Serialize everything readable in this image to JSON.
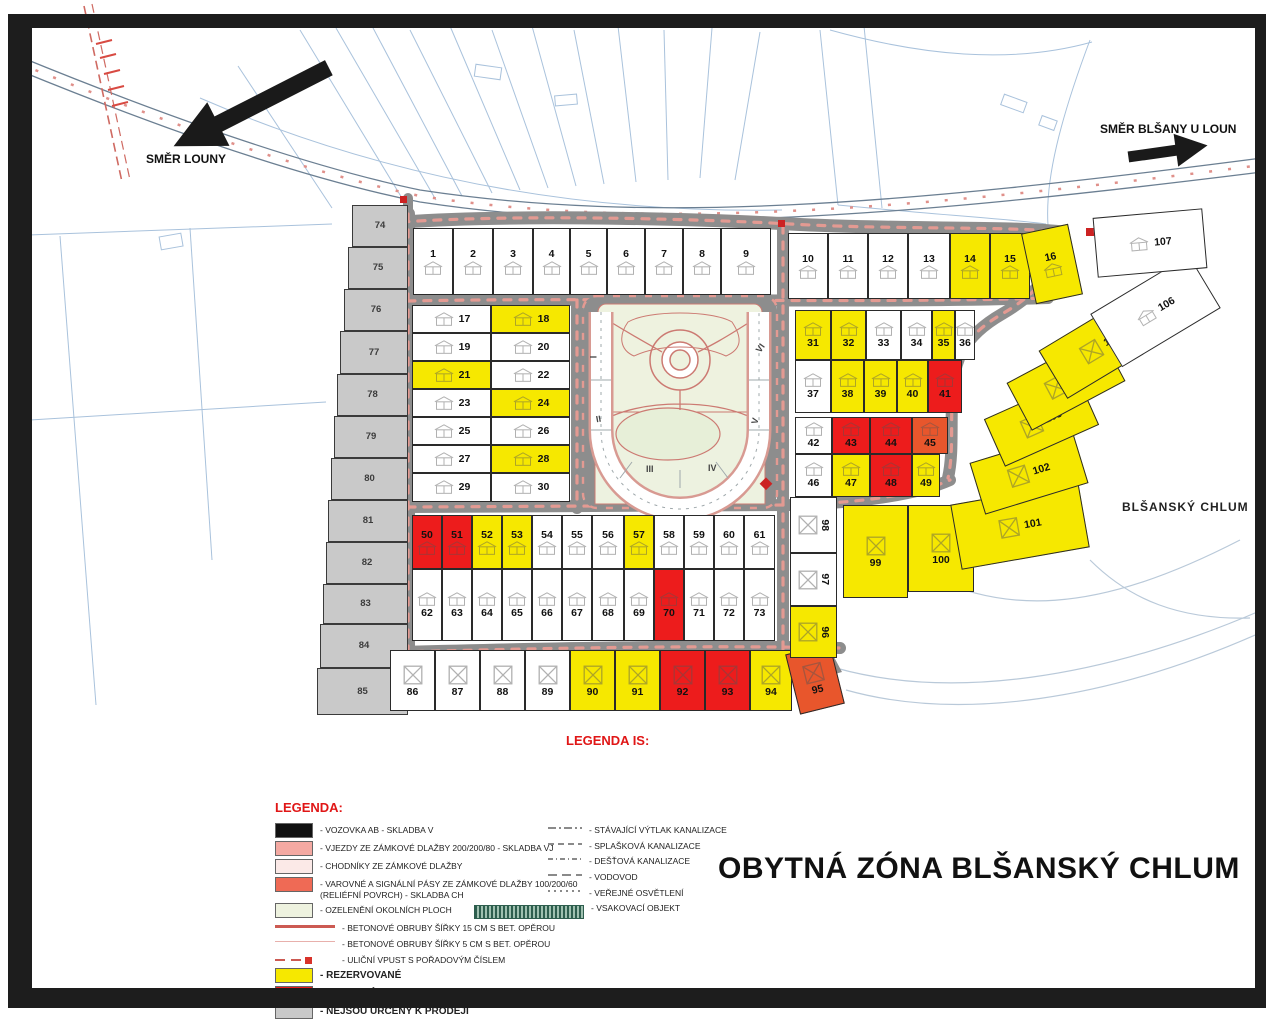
{
  "title": "OBYTNÁ ZÓNA BLŠANSKÝ CHLUM",
  "area_label": "BLŠANSKÝ CHLUM",
  "directions": {
    "west": "SMĚR LOUNY",
    "east": "SMĚR BLŠANY U LOUN"
  },
  "status_colors": {
    "reserved": "#f6e800",
    "sold": "#ed1c1c",
    "sold_alt": "#e8562c",
    "not_for_sale": "#c9c9c9",
    "available": "#ffffff"
  },
  "legend": {
    "title": "LEGENDA:",
    "items": [
      {
        "swatch": "#111111",
        "label": "- VOZOVKA AB - SKLADBA V"
      },
      {
        "swatch": "#f4a9a2",
        "label": "- VJEZDY ZE ZÁMKOVÉ DLAŽBY 200/200/80 - SKLADBA VJ"
      },
      {
        "swatch": "#fbe9e7",
        "label": "- CHODNÍKY ZE ZÁMKOVÉ DLAŽBY"
      },
      {
        "swatch": "#ef6a55",
        "label": "- VAROVNÉ A SIGNÁLNÍ PÁSY ZE ZÁMKOVÉ DLAŽBY 100/200/60 (RELIÉFNÍ POVRCH) - SKLADBA CH"
      },
      {
        "swatch": "#eef2df",
        "label": "- OZELENĚNÍ OKOLNÍCH PLOCH"
      },
      {
        "glyph": "thick",
        "label": "- BETONOVÉ OBRUBY ŠÍŘKY 15 CM S BET. OPĚROU"
      },
      {
        "glyph": "thin",
        "label": "- BETONOVÉ OBRUBY ŠÍŘKY 5 CM S BET. OPĚROU"
      },
      {
        "glyph": "inlet",
        "label": "- ULIČNÍ VPUST S POŘADOVÝM ČÍSLEM"
      },
      {
        "swatch": "#f6e800",
        "label": "- REZERVOVANÉ",
        "bold": true
      },
      {
        "swatch": "#ed1c1c",
        "label": "- PRODANÉ",
        "bold": true
      },
      {
        "swatch": "#c9c9c9",
        "label": "- NEJSOU URČENY K PRODEJI",
        "bold": true
      }
    ]
  },
  "legend_is": {
    "title": "LEGENDA IS:",
    "items": [
      {
        "glyph": "dashdot",
        "label": "- STÁVAJÍCÍ VÝTLAK KANALIZACE"
      },
      {
        "glyph": "dash",
        "label": "- SPLAŠKOVÁ KANALIZACE"
      },
      {
        "glyph": "dashdot2",
        "label": "- DEŠŤOVÁ KANALIZACE"
      },
      {
        "glyph": "dash2",
        "label": "- VODOVOD"
      },
      {
        "glyph": "dot",
        "label": "- VEŘEJNÉ OSVĚTLENÍ"
      },
      {
        "glyph": "bar",
        "label": "- VSAKOVACÍ OBJEKT"
      }
    ]
  },
  "park_numerals": [
    {
      "t": "I",
      "x": 592,
      "y": 352,
      "r": -90
    },
    {
      "t": "II",
      "x": 596,
      "y": 414,
      "r": -10
    },
    {
      "t": "III",
      "x": 646,
      "y": 464,
      "r": 0
    },
    {
      "t": "IV",
      "x": 708,
      "y": 463,
      "r": 0
    },
    {
      "t": "V",
      "x": 752,
      "y": 416,
      "r": -75
    },
    {
      "t": "VI",
      "x": 756,
      "y": 343,
      "r": -55
    }
  ],
  "parcels": [
    [
      "1",
      413,
      228,
      40,
      67,
      "a",
      "h",
      "t",
      0
    ],
    [
      "2",
      453,
      228,
      40,
      67,
      "a",
      "h",
      "t",
      0
    ],
    [
      "3",
      493,
      228,
      40,
      67,
      "a",
      "h",
      "t",
      0
    ],
    [
      "4",
      533,
      228,
      37,
      67,
      "a",
      "h",
      "t",
      0
    ],
    [
      "5",
      570,
      228,
      37,
      67,
      "a",
      "h",
      "t",
      0
    ],
    [
      "6",
      607,
      228,
      38,
      67,
      "a",
      "h",
      "t",
      0
    ],
    [
      "7",
      645,
      228,
      38,
      67,
      "a",
      "h",
      "t",
      0
    ],
    [
      "8",
      683,
      228,
      38,
      67,
      "a",
      "h",
      "t",
      0
    ],
    [
      "9",
      721,
      228,
      50,
      67,
      "a",
      "h",
      "t",
      0
    ],
    [
      "10",
      788,
      233,
      40,
      66,
      "a",
      "h",
      "t",
      0
    ],
    [
      "11",
      828,
      233,
      40,
      66,
      "a",
      "h",
      "t",
      0
    ],
    [
      "12",
      868,
      233,
      40,
      66,
      "a",
      "h",
      "t",
      0
    ],
    [
      "13",
      908,
      233,
      42,
      66,
      "a",
      "h",
      "t",
      0
    ],
    [
      "14",
      950,
      233,
      40,
      66,
      "r",
      "h",
      "t",
      0
    ],
    [
      "15",
      990,
      233,
      40,
      66,
      "r",
      "h",
      "t",
      0
    ],
    [
      "16",
      1028,
      228,
      48,
      72,
      "r",
      "h",
      "t",
      -12
    ],
    [
      "17",
      412,
      305,
      79,
      28,
      "a",
      "h",
      "sd",
      0
    ],
    [
      "18",
      491,
      305,
      79,
      28,
      "r",
      "h",
      "sd",
      0
    ],
    [
      "19",
      412,
      333,
      79,
      28,
      "a",
      "h",
      "sd",
      0
    ],
    [
      "20",
      491,
      333,
      79,
      28,
      "a",
      "h",
      "sd",
      0
    ],
    [
      "21",
      412,
      361,
      79,
      28,
      "r",
      "h",
      "sd",
      0
    ],
    [
      "22",
      491,
      361,
      79,
      28,
      "a",
      "h",
      "sd",
      0
    ],
    [
      "23",
      412,
      389,
      79,
      28,
      "a",
      "h",
      "sd",
      0
    ],
    [
      "24",
      491,
      389,
      79,
      28,
      "r",
      "h",
      "sd",
      0
    ],
    [
      "25",
      412,
      417,
      79,
      28,
      "a",
      "h",
      "sd",
      0
    ],
    [
      "26",
      491,
      417,
      79,
      28,
      "a",
      "h",
      "sd",
      0
    ],
    [
      "27",
      412,
      445,
      79,
      28,
      "a",
      "h",
      "sd",
      0
    ],
    [
      "28",
      491,
      445,
      79,
      28,
      "r",
      "h",
      "sd",
      0
    ],
    [
      "29",
      412,
      473,
      79,
      29,
      "a",
      "h",
      "sd",
      0
    ],
    [
      "30",
      491,
      473,
      79,
      29,
      "a",
      "h",
      "sd",
      0
    ],
    [
      "31",
      795,
      310,
      36,
      50,
      "r",
      "h",
      "b",
      0
    ],
    [
      "32",
      831,
      310,
      35,
      50,
      "r",
      "h",
      "b",
      0
    ],
    [
      "33",
      866,
      310,
      35,
      50,
      "a",
      "h",
      "b",
      0
    ],
    [
      "34",
      901,
      310,
      31,
      50,
      "a",
      "h",
      "b",
      0
    ],
    [
      "35",
      932,
      310,
      23,
      50,
      "r",
      "h",
      "b",
      0
    ],
    [
      "36",
      955,
      310,
      20,
      50,
      "a",
      "h",
      "b",
      0
    ],
    [
      "37",
      795,
      360,
      36,
      53,
      "a",
      "h",
      "b",
      0
    ],
    [
      "38",
      831,
      360,
      33,
      53,
      "r",
      "h",
      "b",
      0
    ],
    [
      "39",
      864,
      360,
      33,
      53,
      "r",
      "h",
      "b",
      0
    ],
    [
      "40",
      897,
      360,
      31,
      53,
      "r",
      "h",
      "b",
      0
    ],
    [
      "41",
      928,
      360,
      34,
      53,
      "s",
      "h",
      "b",
      0
    ],
    [
      "42",
      795,
      417,
      37,
      37,
      "a",
      "h",
      "b",
      0
    ],
    [
      "43",
      832,
      417,
      38,
      37,
      "s",
      "h",
      "b",
      0
    ],
    [
      "44",
      870,
      417,
      42,
      37,
      "s",
      "h",
      "b",
      0
    ],
    [
      "45",
      912,
      417,
      36,
      37,
      "s2",
      "h",
      "b",
      0
    ],
    [
      "46",
      795,
      454,
      37,
      43,
      "a",
      "h",
      "b",
      0
    ],
    [
      "47",
      832,
      454,
      38,
      43,
      "r",
      "h",
      "b",
      0
    ],
    [
      "48",
      870,
      454,
      42,
      43,
      "s",
      "h",
      "b",
      0
    ],
    [
      "49",
      912,
      454,
      28,
      43,
      "r",
      "h",
      "b",
      0
    ],
    [
      "50",
      412,
      515,
      30,
      54,
      "s",
      "h",
      "t",
      0
    ],
    [
      "51",
      442,
      515,
      30,
      54,
      "s",
      "h",
      "t",
      0
    ],
    [
      "52",
      472,
      515,
      30,
      54,
      "r",
      "h",
      "t",
      0
    ],
    [
      "53",
      502,
      515,
      30,
      54,
      "r",
      "h",
      "t",
      0
    ],
    [
      "54",
      532,
      515,
      30,
      54,
      "a",
      "h",
      "t",
      0
    ],
    [
      "55",
      562,
      515,
      30,
      54,
      "a",
      "h",
      "t",
      0
    ],
    [
      "56",
      592,
      515,
      32,
      54,
      "a",
      "h",
      "t",
      0
    ],
    [
      "57",
      624,
      515,
      30,
      54,
      "r",
      "h",
      "t",
      0
    ],
    [
      "58",
      654,
      515,
      30,
      54,
      "a",
      "h",
      "t",
      0
    ],
    [
      "59",
      684,
      515,
      30,
      54,
      "a",
      "h",
      "t",
      0
    ],
    [
      "60",
      714,
      515,
      30,
      54,
      "a",
      "h",
      "t",
      0
    ],
    [
      "61",
      744,
      515,
      31,
      54,
      "a",
      "h",
      "t",
      0
    ],
    [
      "62",
      412,
      569,
      30,
      72,
      "a",
      "h",
      "b",
      0
    ],
    [
      "63",
      442,
      569,
      30,
      72,
      "a",
      "h",
      "b",
      0
    ],
    [
      "64",
      472,
      569,
      30,
      72,
      "a",
      "h",
      "b",
      0
    ],
    [
      "65",
      502,
      569,
      30,
      72,
      "a",
      "h",
      "b",
      0
    ],
    [
      "66",
      532,
      569,
      30,
      72,
      "a",
      "h",
      "b",
      0
    ],
    [
      "67",
      562,
      569,
      30,
      72,
      "a",
      "h",
      "b",
      0
    ],
    [
      "68",
      592,
      569,
      32,
      72,
      "a",
      "h",
      "b",
      0
    ],
    [
      "69",
      624,
      569,
      30,
      72,
      "a",
      "h",
      "b",
      0
    ],
    [
      "70",
      654,
      569,
      30,
      72,
      "s",
      "h",
      "b",
      0
    ],
    [
      "71",
      684,
      569,
      30,
      72,
      "a",
      "h",
      "b",
      0
    ],
    [
      "72",
      714,
      569,
      30,
      72,
      "a",
      "h",
      "b",
      0
    ],
    [
      "73",
      744,
      569,
      31,
      72,
      "a",
      "h",
      "b",
      0
    ],
    [
      "74",
      352,
      205,
      56,
      42,
      "n",
      "",
      "c",
      0
    ],
    [
      "75",
      348,
      247,
      60,
      42,
      "n",
      "",
      "c",
      0
    ],
    [
      "76",
      344,
      289,
      64,
      42,
      "n",
      "",
      "c",
      0
    ],
    [
      "77",
      340,
      331,
      68,
      43,
      "n",
      "",
      "c",
      0
    ],
    [
      "78",
      337,
      374,
      71,
      42,
      "n",
      "",
      "c",
      0
    ],
    [
      "79",
      334,
      416,
      74,
      42,
      "n",
      "",
      "c",
      0
    ],
    [
      "80",
      331,
      458,
      77,
      42,
      "n",
      "",
      "c",
      0
    ],
    [
      "81",
      328,
      500,
      80,
      42,
      "n",
      "",
      "c",
      0
    ],
    [
      "82",
      326,
      542,
      82,
      42,
      "n",
      "",
      "c",
      0
    ],
    [
      "83",
      323,
      584,
      85,
      40,
      "n",
      "",
      "c",
      0
    ],
    [
      "84",
      320,
      624,
      88,
      44,
      "n",
      "",
      "c",
      0
    ],
    [
      "85",
      317,
      668,
      91,
      47,
      "n",
      "",
      "c",
      0
    ],
    [
      "86",
      390,
      650,
      45,
      61,
      "a",
      "x",
      "b",
      0
    ],
    [
      "87",
      435,
      650,
      45,
      61,
      "a",
      "x",
      "b",
      0
    ],
    [
      "88",
      480,
      650,
      45,
      61,
      "a",
      "x",
      "b",
      0
    ],
    [
      "89",
      525,
      650,
      45,
      61,
      "a",
      "x",
      "b",
      0
    ],
    [
      "90",
      570,
      650,
      45,
      61,
      "r",
      "x",
      "b",
      0
    ],
    [
      "91",
      615,
      650,
      45,
      61,
      "r",
      "x",
      "b",
      0
    ],
    [
      "92",
      660,
      650,
      45,
      61,
      "s",
      "x",
      "b",
      0
    ],
    [
      "93",
      705,
      650,
      45,
      61,
      "s",
      "x",
      "b",
      0
    ],
    [
      "94",
      750,
      650,
      42,
      61,
      "r",
      "x",
      "b",
      0
    ],
    [
      "95",
      792,
      648,
      46,
      62,
      "s2",
      "x",
      "b",
      -14
    ],
    [
      "96",
      790,
      606,
      47,
      52,
      "r",
      "x",
      "rt",
      0
    ],
    [
      "97",
      790,
      553,
      47,
      53,
      "a",
      "x",
      "rt",
      0
    ],
    [
      "98",
      790,
      497,
      47,
      56,
      "a",
      "x",
      "rt",
      0
    ],
    [
      "99",
      843,
      505,
      65,
      93,
      "r",
      "x",
      "b",
      0
    ],
    [
      "100",
      908,
      505,
      66,
      87,
      "r",
      "x",
      "b",
      0
    ],
    [
      "101",
      955,
      493,
      130,
      66,
      "r",
      "x",
      "sd",
      -10
    ],
    [
      "102",
      975,
      446,
      108,
      54,
      "r",
      "x",
      "sd",
      -17
    ],
    [
      "103",
      990,
      396,
      103,
      52,
      "r",
      "x",
      "sd",
      -24
    ],
    [
      "104",
      1013,
      355,
      106,
      54,
      "r",
      "x",
      "sd",
      -28
    ],
    [
      "105",
      1045,
      318,
      112,
      56,
      "r",
      "x",
      "sd",
      -31
    ],
    [
      "106",
      1098,
      280,
      115,
      62,
      "a",
      "h",
      "sd",
      -31
    ],
    [
      "107",
      1095,
      213,
      110,
      60,
      "a",
      "h",
      "sd",
      -5
    ]
  ]
}
